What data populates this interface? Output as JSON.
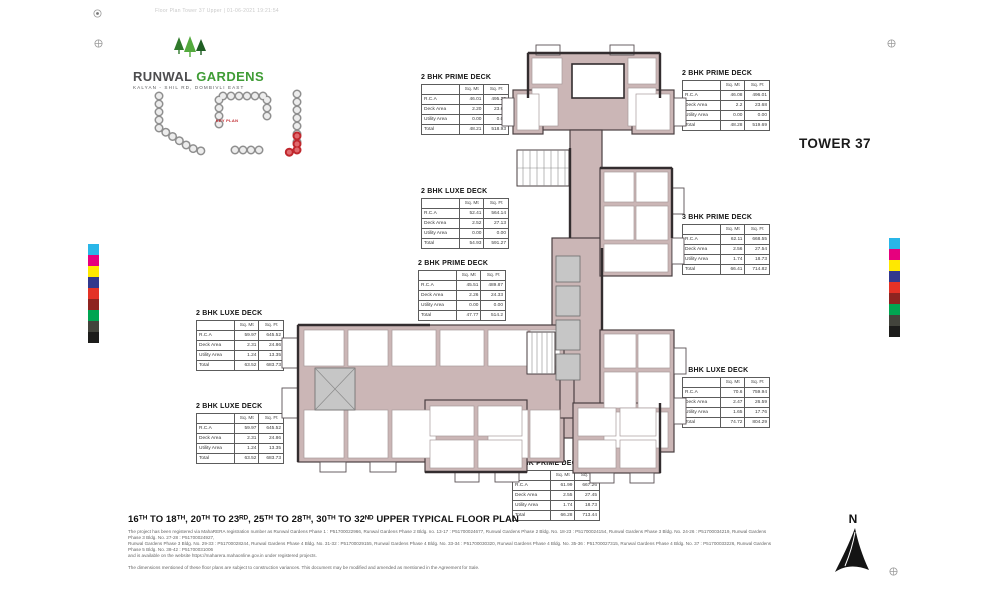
{
  "page": {
    "top_meta": "Floor Plan Tower 37 Upper  |  01-06-2021 19:21:54",
    "tower_label": "TOWER 37",
    "floor_title": "16ᵀᴴ TO 18ᵀᴴ, 20ᵀᴴ TO 23ᴿᴰ, 25ᵀᴴ TO 28ᵀᴴ, 30ᵀᴴ TO 32ᴺᴰ UPPER TYPICAL FLOOR PLAN",
    "north_label": "N"
  },
  "brand": {
    "name_primary": "RUNWAL",
    "name_secondary": "GARDENS",
    "tagline": "KALYAN - SHIL RD, DOMBIVLI EAST",
    "accent_green": "#3f9c35",
    "dark_gray": "#4d4d4f"
  },
  "key_plan": {
    "label": "KEY PLAN",
    "highlight_color": "#c0272d",
    "building_outline": "#8f8f8f",
    "building_fill": "#ededed"
  },
  "tables": [
    {
      "title": "2 BHK PRIME DECK",
      "col_headers": [
        "Sq. Mt",
        "Sq. Ft"
      ],
      "rows": [
        {
          "label": "R.C.A",
          "sqmt": "46.01",
          "sqft": "495.25"
        },
        {
          "label": "Deck Area",
          "sqmt": "2.20",
          "sqft": "23.68"
        },
        {
          "label": "Utility Area",
          "sqmt": "0.00",
          "sqft": "0.00"
        },
        {
          "label": "Total",
          "sqmt": "48.21",
          "sqft": "518.93"
        }
      ]
    },
    {
      "title": "2 BHK PRIME DECK",
      "col_headers": [
        "Sq. Mt",
        "Sq. Ft"
      ],
      "rows": [
        {
          "label": "R.C.A",
          "sqmt": "46.08",
          "sqft": "496.01"
        },
        {
          "label": "Deck Area",
          "sqmt": "2.2",
          "sqft": "23.68"
        },
        {
          "label": "Utility Area",
          "sqmt": "0.00",
          "sqft": "0.00"
        },
        {
          "label": "Total",
          "sqmt": "48.28",
          "sqft": "519.69"
        }
      ]
    },
    {
      "title": "2 BHK LUXE DECK",
      "col_headers": [
        "Sq. Mt",
        "Sq. Ft"
      ],
      "rows": [
        {
          "label": "R.C.A",
          "sqmt": "52.41",
          "sqft": "564.14"
        },
        {
          "label": "Deck Area",
          "sqmt": "2.52",
          "sqft": "27.13"
        },
        {
          "label": "Utility Area",
          "sqmt": "0.00",
          "sqft": "0.00"
        },
        {
          "label": "Total",
          "sqmt": "54.93",
          "sqft": "591.27"
        }
      ]
    },
    {
      "title": "3 BHK PRIME DECK",
      "col_headers": [
        "Sq. Mt",
        "Sq. Ft"
      ],
      "rows": [
        {
          "label": "R.C.A",
          "sqmt": "62.11",
          "sqft": "668.55"
        },
        {
          "label": "Deck Area",
          "sqmt": "2.56",
          "sqft": "27.54"
        },
        {
          "label": "Utility Area",
          "sqmt": "1.74",
          "sqft": "18.73"
        },
        {
          "label": "Total",
          "sqmt": "66.41",
          "sqft": "714.82"
        }
      ]
    },
    {
      "title": "2 BHK PRIME DECK",
      "col_headers": [
        "Sq. Mt",
        "Sq. Ft"
      ],
      "rows": [
        {
          "label": "R.C.A",
          "sqmt": "45.51",
          "sqft": "489.87"
        },
        {
          "label": "Deck Area",
          "sqmt": "2.26",
          "sqft": "24.33"
        },
        {
          "label": "Utility Area",
          "sqmt": "0.00",
          "sqft": "0.00"
        },
        {
          "label": "Total",
          "sqmt": "47.77",
          "sqft": "514.2"
        }
      ]
    },
    {
      "title": "2 BHK LUXE DECK",
      "col_headers": [
        "Sq. Mt",
        "Sq. Ft"
      ],
      "rows": [
        {
          "label": "R.C.A",
          "sqmt": "59.97",
          "sqft": "645.52"
        },
        {
          "label": "Deck Area",
          "sqmt": "2.31",
          "sqft": "24.86"
        },
        {
          "label": "Utility Area",
          "sqmt": "1.24",
          "sqft": "13.35"
        },
        {
          "label": "Total",
          "sqmt": "63.52",
          "sqft": "683.73"
        }
      ]
    },
    {
      "title": "2 BHK LUXE DECK",
      "col_headers": [
        "Sq. Mt",
        "Sq. Ft"
      ],
      "rows": [
        {
          "label": "R.C.A",
          "sqmt": "59.97",
          "sqft": "645.52"
        },
        {
          "label": "Deck Area",
          "sqmt": "2.31",
          "sqft": "24.86"
        },
        {
          "label": "Utility Area",
          "sqmt": "1.24",
          "sqft": "13.35"
        },
        {
          "label": "Total",
          "sqmt": "63.52",
          "sqft": "683.73"
        }
      ]
    },
    {
      "title": "3 BHK LUXE DECK",
      "col_headers": [
        "Sq. Mt",
        "Sq. Ft"
      ],
      "rows": [
        {
          "label": "R.C.A",
          "sqmt": "70.6",
          "sqft": "759.94"
        },
        {
          "label": "Deck Area",
          "sqmt": "2.47",
          "sqft": "26.59"
        },
        {
          "label": "Utility Area",
          "sqmt": "1.65",
          "sqft": "17.76"
        },
        {
          "label": "Total",
          "sqmt": "74.72",
          "sqft": "804.29"
        }
      ]
    },
    {
      "title": "3 BHK PRIME DECK",
      "col_headers": [
        "Sq. Mt",
        "Sq. Ft"
      ],
      "rows": [
        {
          "label": "R.C.A",
          "sqmt": "61.99",
          "sqft": "667.26"
        },
        {
          "label": "Deck Area",
          "sqmt": "2.55",
          "sqft": "27.45"
        },
        {
          "label": "Utility Area",
          "sqmt": "1.74",
          "sqft": "18.73"
        },
        {
          "label": "Total",
          "sqmt": "66.28",
          "sqft": "713.44"
        }
      ]
    }
  ],
  "notes": {
    "lines": [
      "The project has been registered via MahaRERA registration number as Runwal Gardens Phase 1 : P51700022966, Runwal Gardens Phase 2 Bldg. no. 13-17 : P51700024677, Runwal Gardens Phase 2 Bldg. No. 18-23 : P51700024154, Runwal Gardens Phase 3 Bldg. No. 24-26 : P51700034219, Runwal Gardens Phase 3 Bldg. No. 27-28 : P51700024927,",
      "Runwal Gardens Phase 3 Bldg. No. 29-33 : P51700028244, Runwal Gardens Phase 4 Bldg. No. 31-32 : P51700029155, Runwal Gardens Phase 4 Bldg. No. 33-34 : P51700030320, Runwal Gardens Phase 4 Bldg. No. 35-36 : P51700027315, Runwal Gardens Phase 4 Bldg. No. 37 : P51700033226, Runwal Gardens Phase 5 Bldg. No. 38-42 : P51700031006",
      "and is available on the website https://maharera.mahaonline.gov.in under registered projects."
    ],
    "disclaimer": "The dimensions mentioned of these floor plans are subject to construction variances. This document may be modified and amended as mentioned in the Agreement for Sale."
  },
  "colors": {
    "plan_fill": "#cbb6b6",
    "plan_wall": "#453b3d",
    "swatches": [
      "#29b6e8",
      "#e6007e",
      "#ffe800",
      "#32388d",
      "#e43226",
      "#8e2420",
      "#00a551",
      "#43443c",
      "#1d1d1b"
    ]
  }
}
